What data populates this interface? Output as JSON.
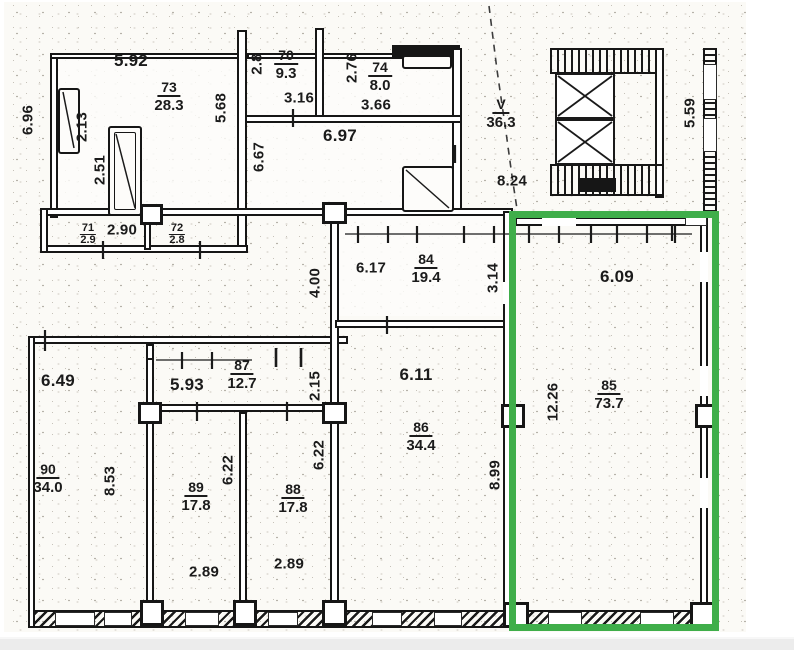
{
  "document": {
    "type": "scanned-floor-plan",
    "highlight": {
      "room_number": "85",
      "color": "#3fae4a"
    }
  },
  "rooms": {
    "r73": {
      "num": "73",
      "area": "28.3"
    },
    "r70": {
      "num": "70",
      "area": "9.3"
    },
    "r74": {
      "num": "74",
      "area": "8.0"
    },
    "rV": {
      "num": "V",
      "area": "36.3"
    },
    "r71": {
      "num": "71",
      "area": "2.9"
    },
    "r72": {
      "num": "72",
      "area": "2.8"
    },
    "r84": {
      "num": "84",
      "area": "19.4"
    },
    "r87": {
      "num": "87",
      "area": "12.7"
    },
    "r85": {
      "num": "85",
      "area": "73.7"
    },
    "r86": {
      "num": "86",
      "area": "34.4"
    },
    "r89": {
      "num": "89",
      "area": "17.8"
    },
    "r88": {
      "num": "88",
      "area": "17.8"
    },
    "r90": {
      "num": "90",
      "area": "34.0"
    }
  },
  "dims": {
    "d5_92": "5.92",
    "d2_13": "2.13",
    "d6_96": "6.96",
    "d2_51": "2.51",
    "d5_68": "5.68",
    "d2_8": "2.8",
    "d3_16": "3.16",
    "d2_76": "2.76",
    "d3_66": "3.66",
    "d6_97": "6.97",
    "d6_67": "6.67",
    "d8_24": "8.24",
    "d5_59": "5.59",
    "d2_90": "2.90",
    "d6_17": "6.17",
    "d3_14": "3.14",
    "d4_00": "4.00",
    "d6_09": "6.09",
    "d6_49": "6.49",
    "d5_93": "5.93",
    "d2_15": "2.15",
    "d6_11": "6.11",
    "d12_26": "12.26",
    "d8_99": "8.99",
    "d6_22": "6.22",
    "d8_53": "8.53",
    "d2_89": "2.89"
  }
}
